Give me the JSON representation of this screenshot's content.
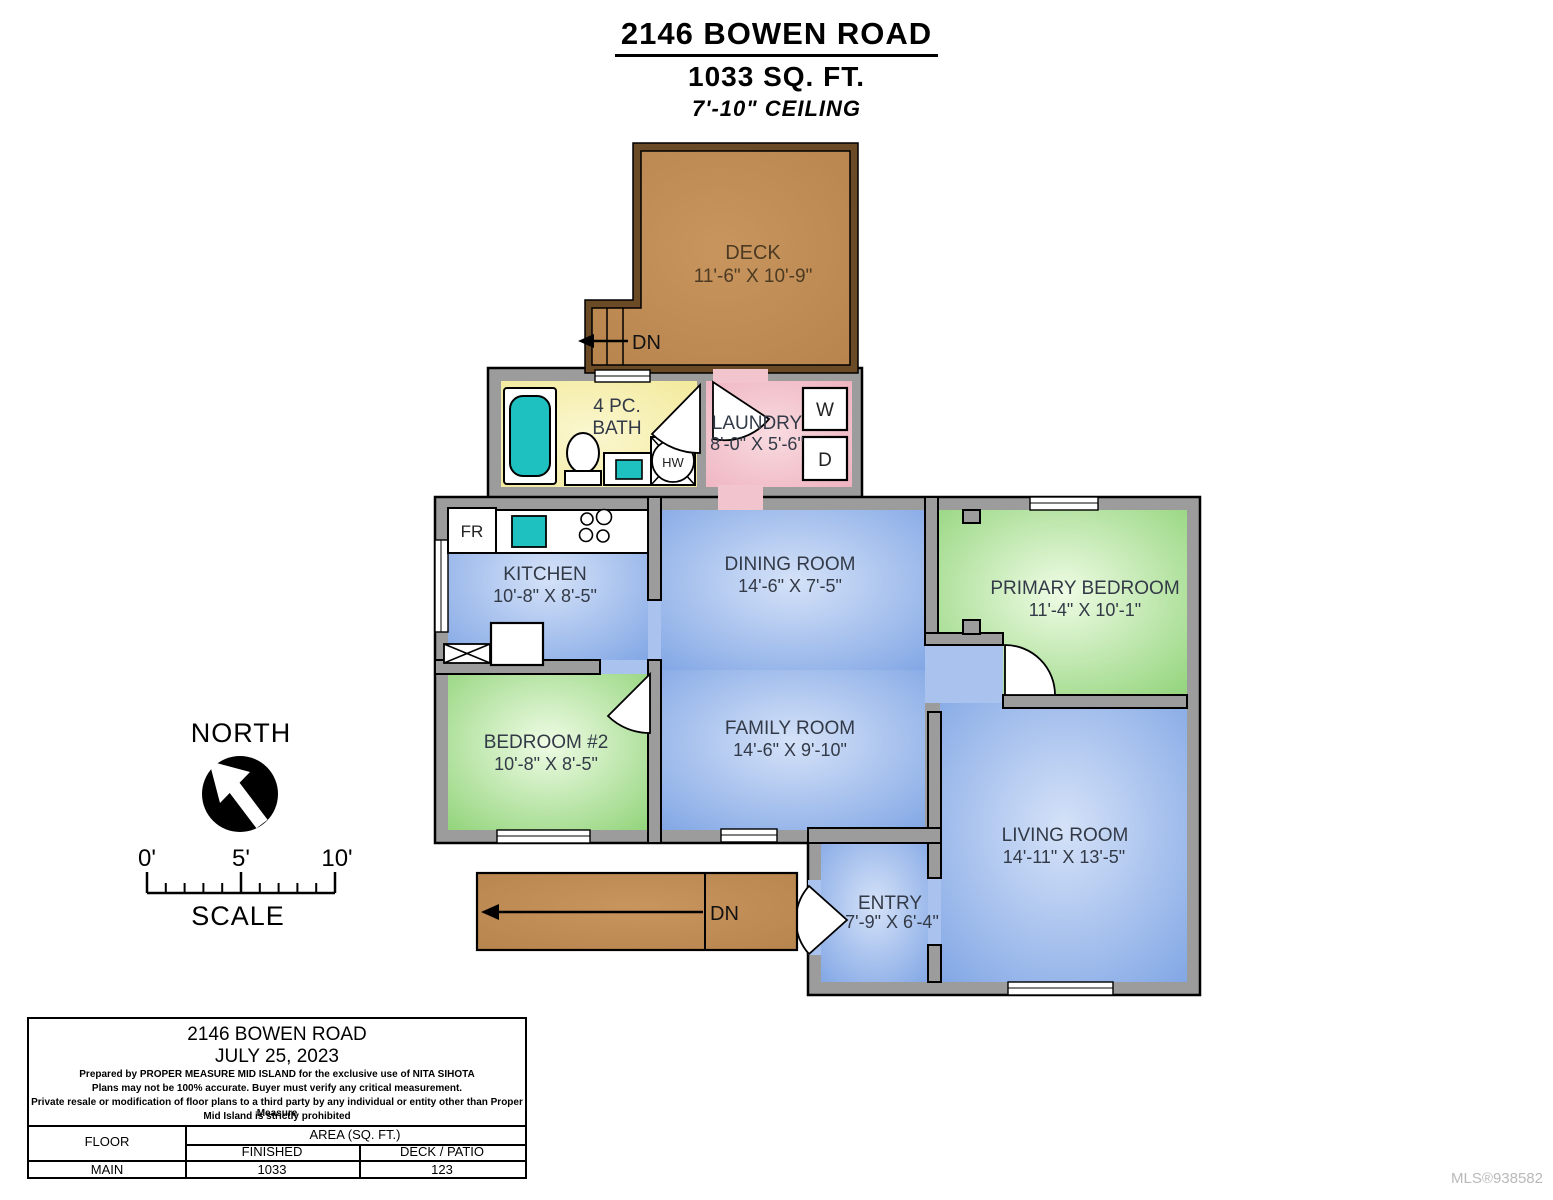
{
  "title": {
    "address": "2146 BOWEN ROAD",
    "area": "1033 SQ. FT.",
    "ceiling": "7'-10\" CEILING"
  },
  "rooms": {
    "deck": {
      "name": "DECK",
      "dims": "11'-6\" X 10'-9\""
    },
    "bath": {
      "line1": "4 PC.",
      "line2": "BATH"
    },
    "laundry": {
      "name": "LAUNDRY",
      "dims": "8'-0\" X 5'-6\""
    },
    "kitchen": {
      "name": "KITCHEN",
      "dims": "10'-8\" X 8'-5\""
    },
    "dining": {
      "name": "DINING ROOM",
      "dims": "14'-6\" X 7'-5\""
    },
    "primary": {
      "name": "PRIMARY BEDROOM",
      "dims": "11'-4\" X 10'-1\""
    },
    "bedroom2": {
      "name": "BEDROOM #2",
      "dims": "10'-8\" X 8'-5\""
    },
    "family": {
      "name": "FAMILY ROOM",
      "dims": "14'-6\" X 9'-10\""
    },
    "living": {
      "name": "LIVING ROOM",
      "dims": "14'-11\" X 13'-5\""
    },
    "entry": {
      "name": "ENTRY",
      "dims": "7'-9\" X 6'-4\""
    }
  },
  "labels": {
    "down_deck": "DN",
    "down_entry": "DN"
  },
  "fixtures": {
    "fridge": "FR",
    "washer": "W",
    "dryer": "D",
    "water_heater": "HW"
  },
  "compass": {
    "label": "NORTH"
  },
  "scale_bar": {
    "tick_0": "0'",
    "tick_5": "5'",
    "tick_10": "10'",
    "label": "SCALE"
  },
  "info_box": {
    "address": "2146 BOWEN ROAD",
    "date": "JULY 25, 2023",
    "disclaimer1": "Prepared by PROPER MEASURE MID ISLAND for the exclusive use of NITA SIHOTA",
    "disclaimer2": "Plans may not be 100% accurate.  Buyer must verify any critical measurement.",
    "disclaimer3": "Private resale  or modification of floor plans to a third party by any individual or entity other than Proper Measure",
    "disclaimer4": "Mid Island is strictly prohibited",
    "table": {
      "floor_header": "FLOOR",
      "area_header": "AREA (SQ. FT.)",
      "finished_header": "FINISHED",
      "deck_header": "DECK / PATIO",
      "row_floor": "MAIN",
      "row_finished": "1033",
      "row_deck": "123"
    }
  },
  "watermark": "MLS®938582",
  "colors": {
    "wall_gray": "#9c9c9c",
    "deck_fill": "#bf8a50",
    "deck_wall": "#6b4a26",
    "bath_yellow": "#f1e896",
    "laundry_pink": "#eeafbd",
    "living_blue": "#7ea4e4",
    "bedroom_green": "#8ed276",
    "fixture_teal": "#1fc0c0"
  }
}
